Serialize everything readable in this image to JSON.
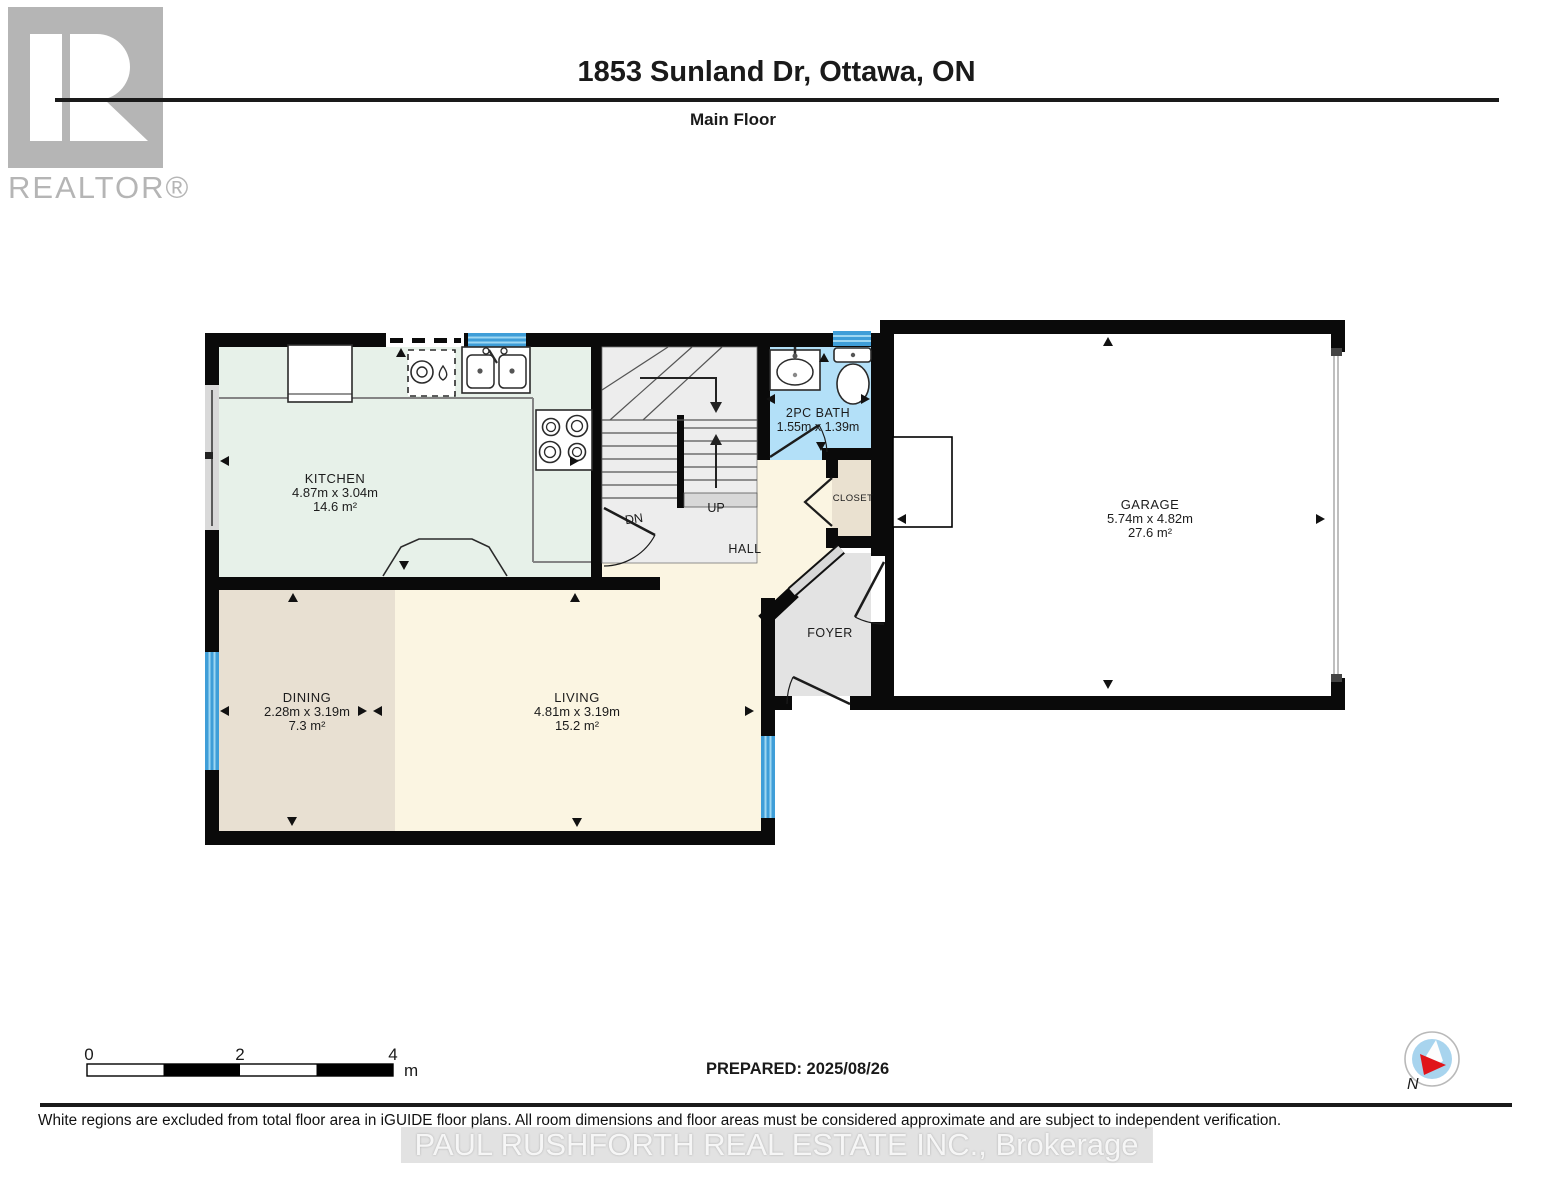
{
  "header": {
    "title": "1853 Sunland Dr, Ottawa, ON",
    "subtitle": "Main Floor"
  },
  "logo": {
    "wordmark": "REALTOR®"
  },
  "rooms": {
    "kitchen": {
      "name": "KITCHEN",
      "dims": "4.87m x 3.04m",
      "area": "14.6 m²"
    },
    "dining": {
      "name": "DINING",
      "dims": "2.28m x 3.19m",
      "area": "7.3 m²"
    },
    "living": {
      "name": "LIVING",
      "dims": "4.81m x 3.19m",
      "area": "15.2 m²"
    },
    "garage": {
      "name": "GARAGE",
      "dims": "5.74m x 4.82m",
      "area": "27.6 m²"
    },
    "bath": {
      "name": "2PC BATH",
      "dims": "1.55m x 1.39m"
    },
    "closet": {
      "name": "CLOSET"
    },
    "hall": {
      "name": "HALL"
    },
    "foyer": {
      "name": "FOYER"
    },
    "stairs_up": {
      "label": "UP"
    },
    "stairs_down": {
      "label": "DN"
    }
  },
  "scale_bar": {
    "labels": [
      "0",
      "2",
      "4"
    ],
    "unit": "m"
  },
  "prepared_label": "PREPARED: 2025/08/26",
  "compass": {
    "label": "N"
  },
  "disclaimer": "White regions are excluded from total floor area in iGUIDE floor plans. All room dimensions and floor areas must be considered approximate and are subject to independent verification.",
  "watermark": "PAUL RUSHFORTH REAL ESTATE INC., Brokerage",
  "colors": {
    "kitchen": "#e7f1e9",
    "dining": "#e8e0d2",
    "living": "#fbf5e2",
    "bath": "#b3e0f8",
    "closet": "#eae1d0",
    "foyer": "#e3e3e3",
    "stairs": "#ededed",
    "wall": "#0a0a0a",
    "window": "#3f9ed8",
    "logo_gray": "#b5b5b5"
  }
}
